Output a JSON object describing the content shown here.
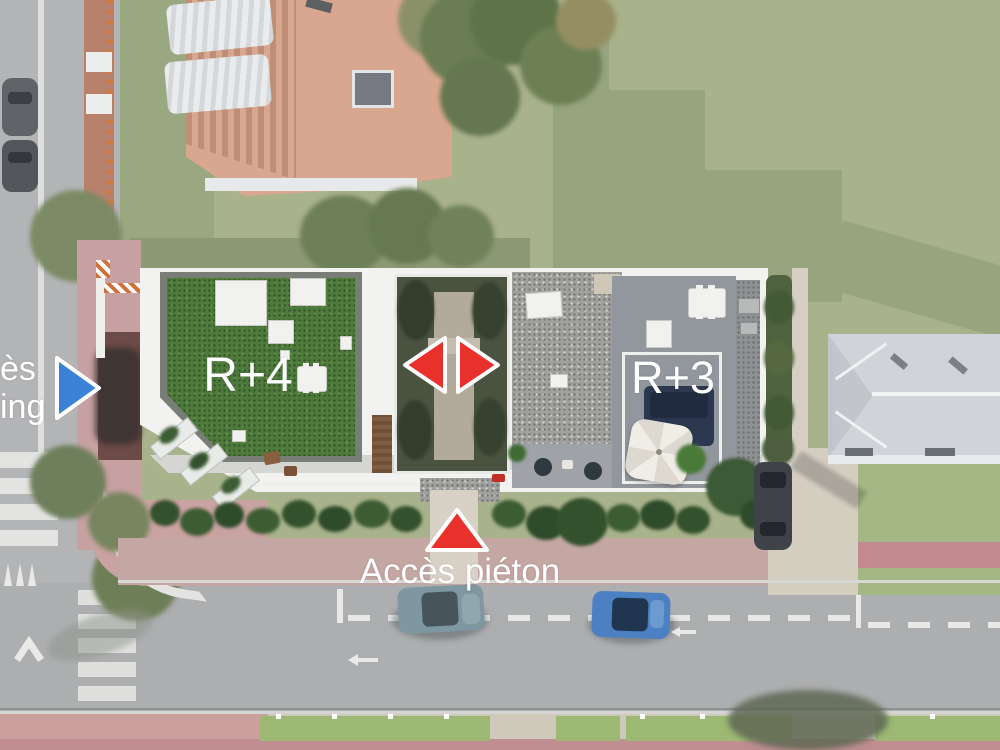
{
  "scene": {
    "title": "Aerial architectural site plan rendering",
    "labels": {
      "left_building_level": "R+4",
      "right_building_level": "R+3",
      "pedestrian_access": "Accès piéton",
      "parking_access_partial": {
        "line1": "ès",
        "line2": "ing"
      }
    },
    "arrows": [
      {
        "id": "parking-access-arrow",
        "direction": "right",
        "color": "#3b82d6"
      },
      {
        "id": "courtyard-arrow-left",
        "direction": "left",
        "color": "#e8312a"
      },
      {
        "id": "courtyard-arrow-right",
        "direction": "right",
        "color": "#e8312a"
      },
      {
        "id": "pedestrian-access-arrow",
        "direction": "up",
        "color": "#e8312a"
      }
    ],
    "colors": {
      "annotation_red": "#e8312a",
      "annotation_blue": "#3b82d6",
      "label_text": "#ffffff",
      "green_roof": "#4e7a3c",
      "lawn": "#a8b28b",
      "road": "#adaeb0",
      "pink_sidewalk": "#c4a6a3",
      "building_white": "#f2f3f1"
    }
  }
}
